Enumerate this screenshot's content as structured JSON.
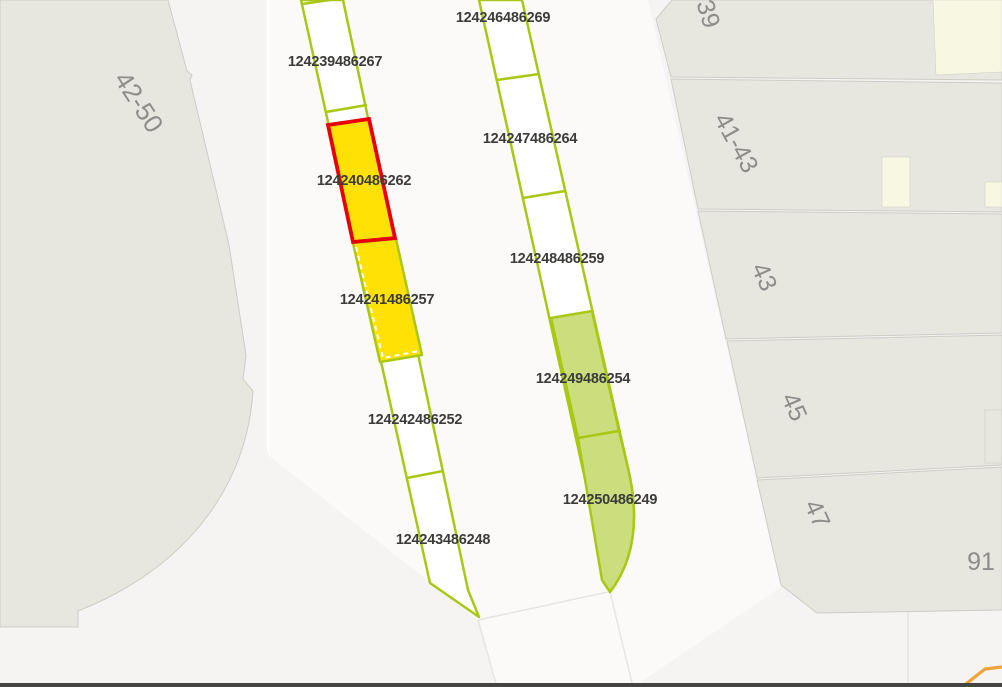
{
  "map": {
    "colors": {
      "background": "#F5F4F2",
      "road": "#FBFAF9",
      "building_fill": "#E7E6DF",
      "building_stroke": "#CDCCC5",
      "courtyard_fill": "#F8F7E1",
      "bay_stroke": "#A9C816",
      "bay_fill": "#FFFFFF",
      "bay_yellow": "#FFE105",
      "bay_green": "#CBDD7C",
      "selection_red": "#E80009",
      "route_orange": "#F1A33B",
      "bay_label": "#3B3B39",
      "building_label": "#8D8D89",
      "faint_line": "#E6E5E2",
      "bottom_bar": "#454442"
    },
    "bay_labels": [
      {
        "text": "124246486269",
        "x": 503,
        "y": 18
      },
      {
        "text": "124239486267",
        "x": 335,
        "y": 62
      },
      {
        "text": "124247486264",
        "x": 530,
        "y": 139
      },
      {
        "text": "124240486262",
        "x": 364,
        "y": 181
      },
      {
        "text": "124248486259",
        "x": 557,
        "y": 259
      },
      {
        "text": "124241486257",
        "x": 387,
        "y": 300
      },
      {
        "text": "124249486254",
        "x": 583,
        "y": 379
      },
      {
        "text": "124242486252",
        "x": 415,
        "y": 420
      },
      {
        "text": "124250486249",
        "x": 610,
        "y": 500
      },
      {
        "text": "124243486248",
        "x": 443,
        "y": 540
      }
    ],
    "building_labels": [
      {
        "text": "42-50",
        "x": 139,
        "y": 102,
        "rot": 57,
        "size": 26
      },
      {
        "text": "39",
        "x": 708,
        "y": 14,
        "rot": 73,
        "size": 25
      },
      {
        "text": "41-43",
        "x": 736,
        "y": 143,
        "rot": 61,
        "size": 25
      },
      {
        "text": "43",
        "x": 764,
        "y": 277,
        "rot": 66,
        "size": 25
      },
      {
        "text": "45",
        "x": 794,
        "y": 407,
        "rot": 66,
        "size": 25
      },
      {
        "text": "47",
        "x": 817,
        "y": 514,
        "rot": 66,
        "size": 25
      },
      {
        "text": "91",
        "x": 981,
        "y": 562,
        "rot": 0,
        "size": 25
      }
    ]
  }
}
